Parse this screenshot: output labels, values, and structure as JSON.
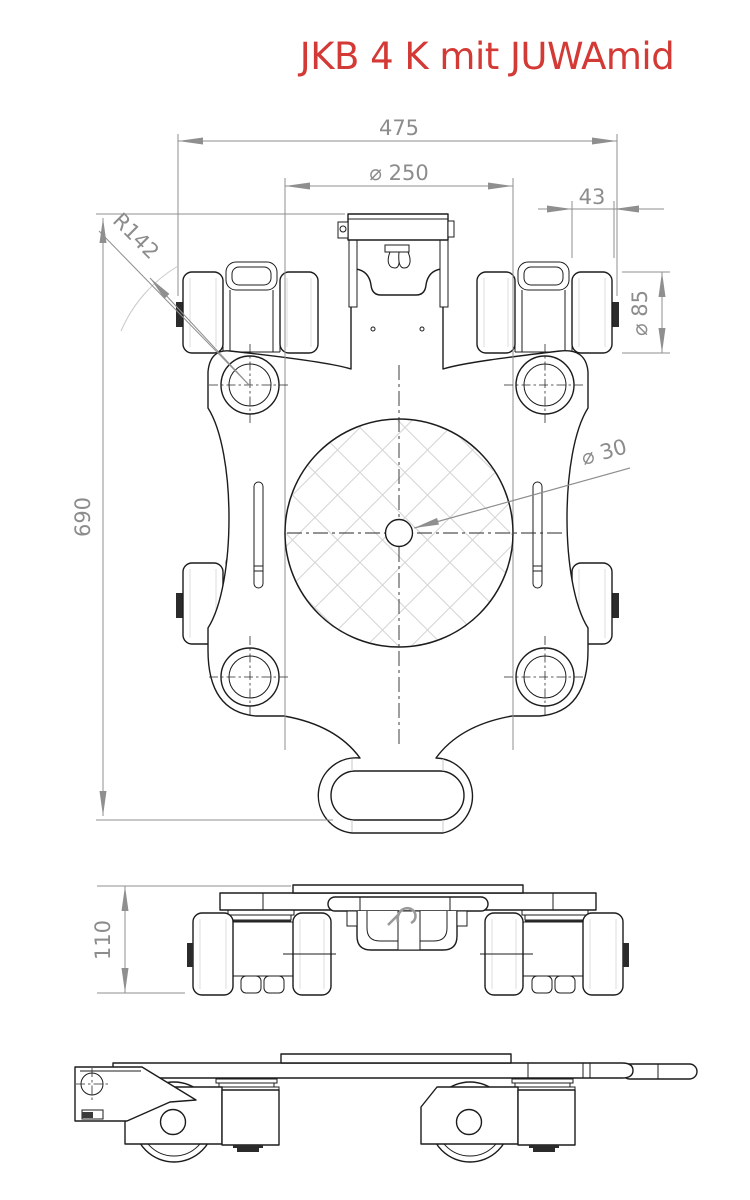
{
  "title": {
    "text": "JKB 4 K mit JUWAmid",
    "color": "#d43a35"
  },
  "drawing": {
    "type": "technical-drawing",
    "product": "machine moving skate with turntable",
    "views": {
      "top": {
        "label": "top view"
      },
      "front": {
        "label": "front view"
      },
      "side": {
        "label": "side view"
      }
    },
    "dimensions": {
      "overall_width": "475",
      "turntable_diameter": "⌀ 250",
      "roller_face_width": "43",
      "roller_diameter": "⌀ 85",
      "swing_radius": "R142",
      "overall_length": "690",
      "center_hole_diameter": "⌀ 30",
      "height": "110"
    },
    "colors": {
      "outline": "#1c1c1c",
      "dimension": "#8f8f8f",
      "hatch": "#d6d6d6",
      "detail_light": "#c9c9c9",
      "background": "#ffffff"
    }
  }
}
